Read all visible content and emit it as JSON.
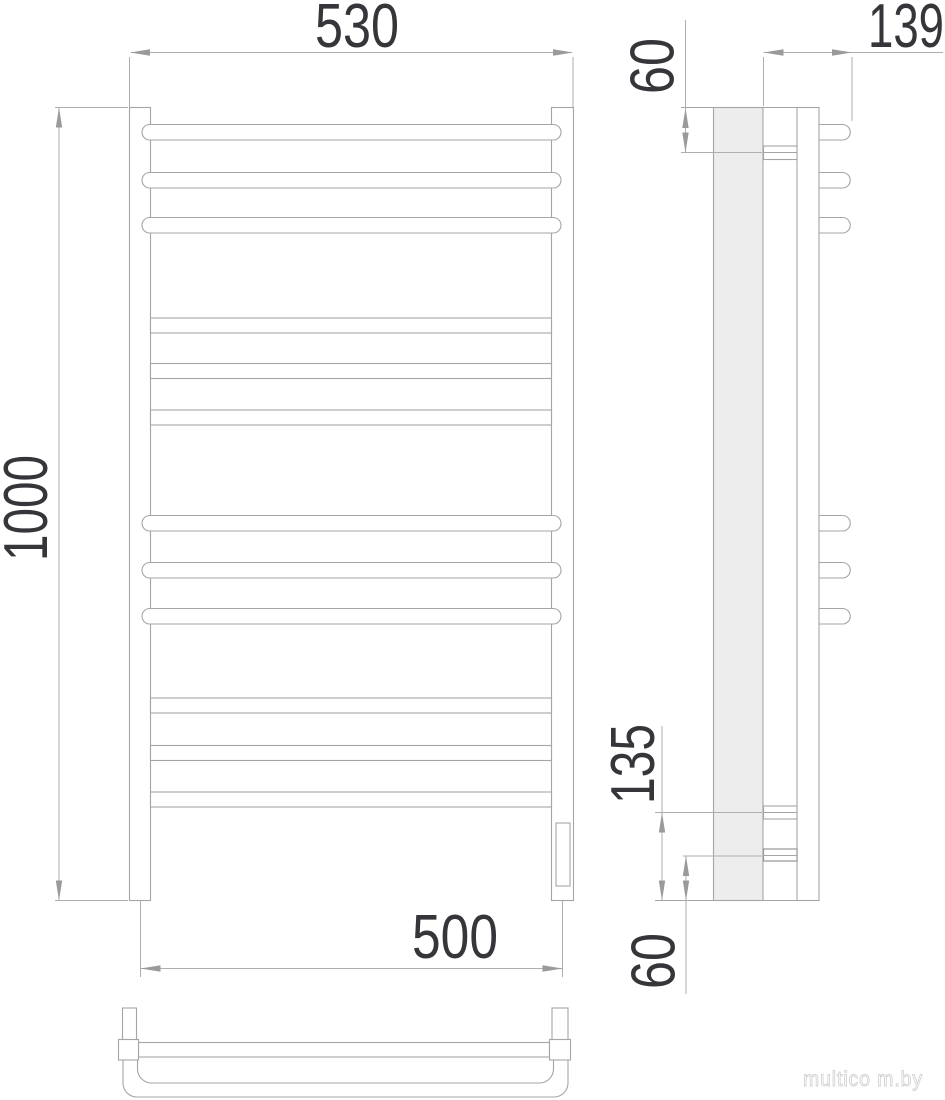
{
  "dims": {
    "front_width_top": "530",
    "front_height": "1000",
    "front_width_bottom": "500",
    "side_depth": "139",
    "side_top_offset": "60",
    "side_bottom_upper": "135",
    "side_bottom_lower": "60"
  },
  "watermark": "multico m.by",
  "colors": {
    "line": "#a5a5a5",
    "dimension_line": "#aeaeae",
    "arrow": "#9a9a9a",
    "dimension_text": "#35353a",
    "wall_fill": "#ededed",
    "watermark": "#d2d2d2",
    "background": "#ffffff"
  }
}
